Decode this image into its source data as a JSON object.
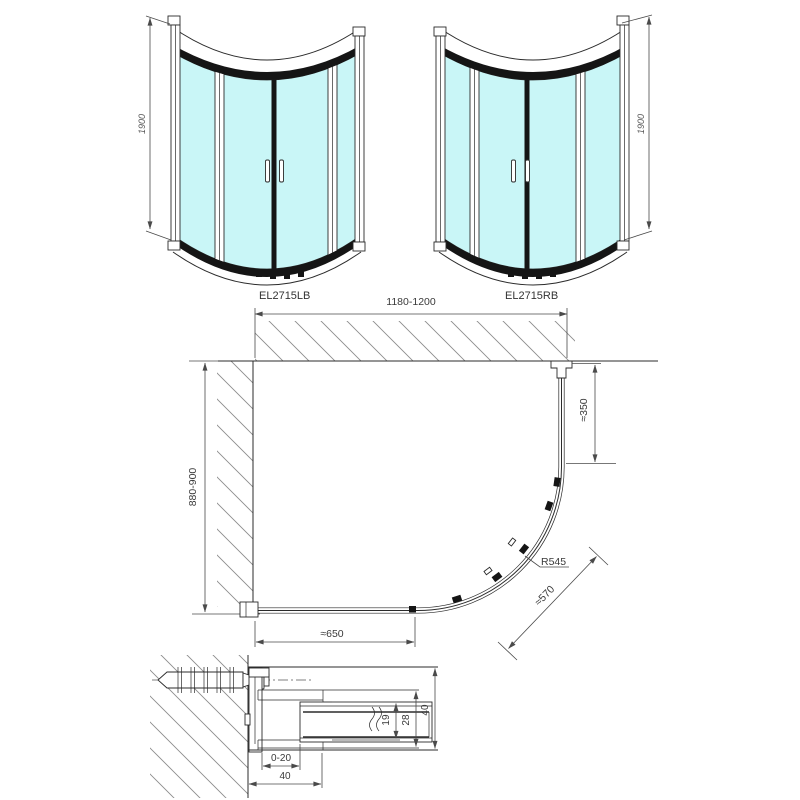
{
  "drawing": {
    "views": {
      "front_left": {
        "label": "EL2715LB",
        "height": "1900"
      },
      "front_right": {
        "label": "EL2715RB",
        "height": "1900"
      },
      "plan": {
        "width": "1180-1200",
        "depth": "880-900",
        "side": "≈350",
        "radius": "R545",
        "diagonal": "≈570",
        "front": "≈650"
      },
      "detail": {
        "adjustment": "0-20",
        "bottom_width": "40",
        "glass_channel": "19",
        "profile_inner": "28",
        "profile_outer": "40"
      }
    },
    "colors": {
      "glass": "#c9f6f7",
      "outline": "#2b2b2b",
      "dim": "#4a4a4a",
      "dark": "#151515",
      "hatch": "#8c8c8c"
    }
  }
}
